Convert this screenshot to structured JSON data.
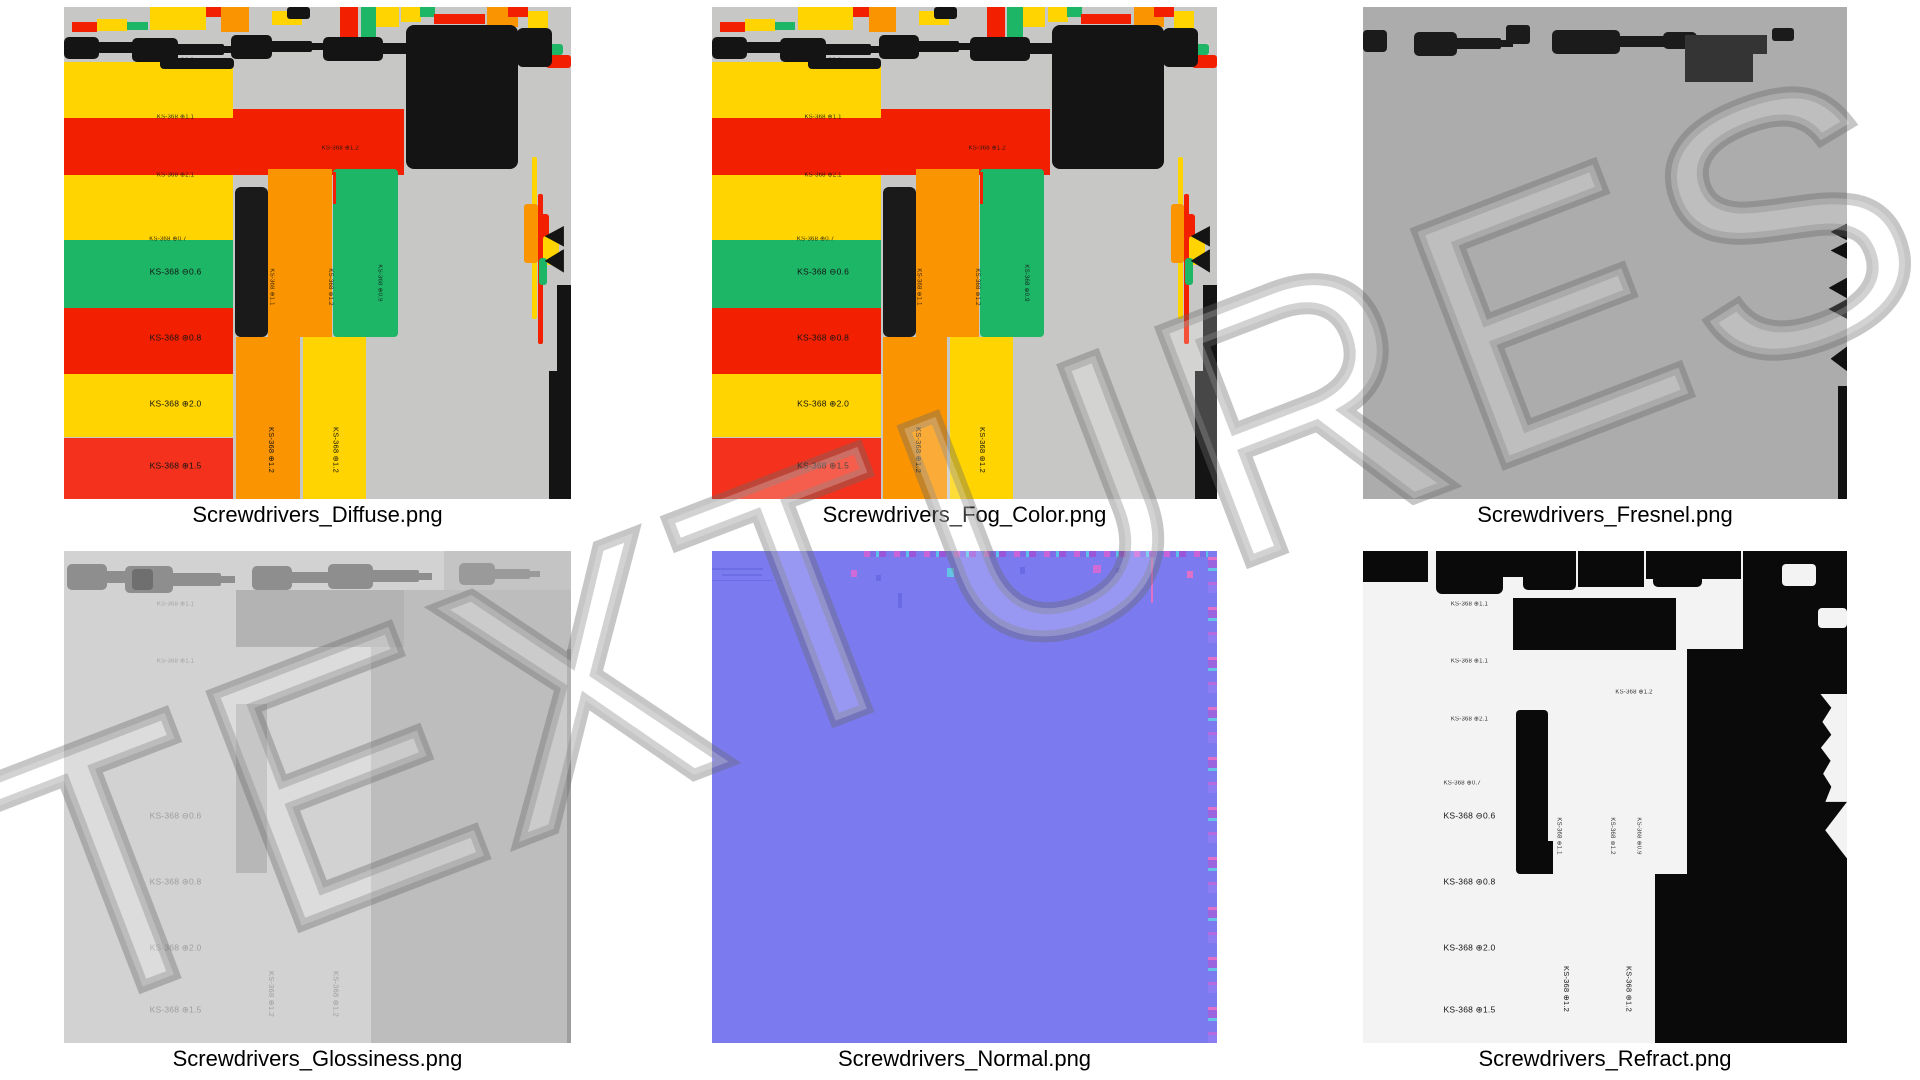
{
  "watermark": {
    "text": "TEXTURES"
  },
  "tiles": [
    {
      "id": "diffuse",
      "filename": "Screwdrivers_Diffuse.png"
    },
    {
      "id": "fog_color",
      "filename": "Screwdrivers_Fog_Color.png"
    },
    {
      "id": "fresnel",
      "filename": "Screwdrivers_Fresnel.png"
    },
    {
      "id": "glossiness",
      "filename": "Screwdrivers_Glossiness.png"
    },
    {
      "id": "normal",
      "filename": "Screwdrivers_Normal.png"
    },
    {
      "id": "refract",
      "filename": "Screwdrivers_Refract.png"
    }
  ],
  "part_labels": {
    "tiny_top": "KS-368 ⊕1.1",
    "tiny_upper": "KS-368 ⊕1.1",
    "tiny_mid": "KS-368 ⊕2.1",
    "tiny_low": "KS-368 ⊕0.7",
    "slot_06": "KS-368 ⊖0.6",
    "torx_08": "KS-368 ⊛0.8",
    "phillips_20": "KS-368 ⊕2.0",
    "phillips_15": "KS-368 ⊕1.5",
    "tiny_green": "KS-368 ⊕1.2",
    "vert_mid_a": "KS-368 ⊕1.1",
    "vert_mid_b": "KS-368 ⊛1.2",
    "vert_mid_c": "KS-368 ⊕0.9",
    "vert_phillips_12": "KS-368 ⊕1.2",
    "vert_torx_12": "KS-368 ⊛1.2"
  },
  "palette": {
    "diffuse_bg": "#c7c7c5",
    "yellow": "#ffd400",
    "red": "#f22000",
    "red_light": "#f3311c",
    "orange": "#fa9400",
    "green": "#1db566",
    "black": "#141414",
    "fresnel_bg": "#acacac",
    "fresnel_dark": "#343434",
    "gloss_bg": "#d2d2d2",
    "gloss_dark": "#bdbdbd",
    "gloss_silhouette": "#8e8e8e",
    "normal_bg": "#7b7bef",
    "refract_bg": "#f3f3f3",
    "caption_color": "#000000"
  }
}
